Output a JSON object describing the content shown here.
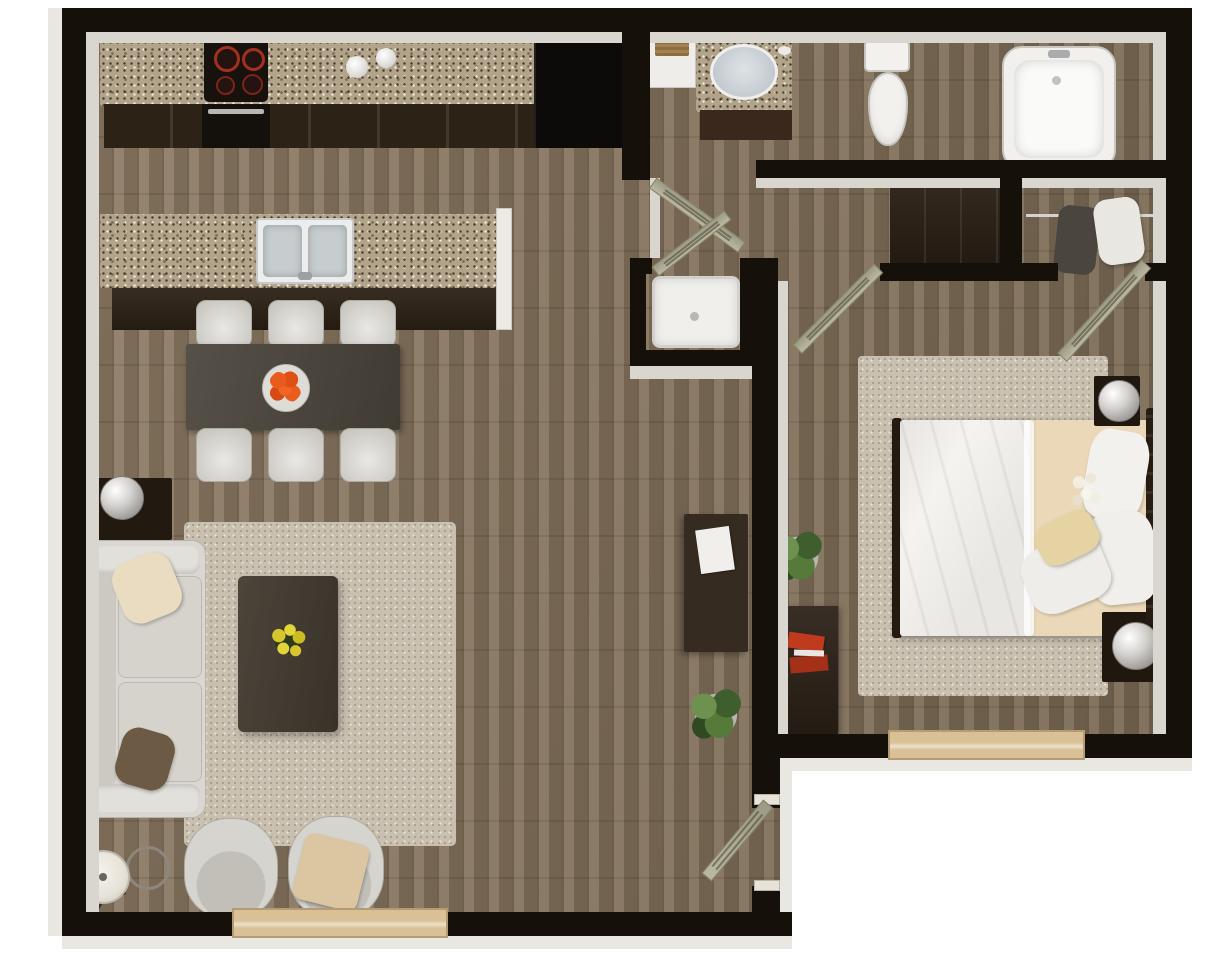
{
  "scene": {
    "type": "floor-plan",
    "render_style": "3d-top-down",
    "description": "One-bedroom apartment 3D floor plan render",
    "rooms": [
      {
        "name": "Kitchen"
      },
      {
        "name": "Dining Area"
      },
      {
        "name": "Living Room"
      },
      {
        "name": "Hallway"
      },
      {
        "name": "Bathroom"
      },
      {
        "name": "Shower Room"
      },
      {
        "name": "Walk-in Closet"
      },
      {
        "name": "Bedroom"
      },
      {
        "name": "Entry"
      }
    ]
  },
  "palette": {
    "wall": "#151009",
    "wall_face": "#d9d6cf",
    "floor_wood": "#86745d",
    "granite": "#b2a48a",
    "cabinet_dark": "#2d2216",
    "door_sage": "#b2b098",
    "rug_beige": "#c9c0b0",
    "fixture_white": "#f2f1ee",
    "sofa_gray": "#d9d7d2",
    "accent_orange": "#e8581f",
    "accent_yellow": "#d8c62e",
    "accent_red": "#c03a1e",
    "pillow_cream": "#e9dcc0",
    "plant_green": "#4c6b38",
    "window_wood": "#d9c096"
  },
  "furniture": {
    "counter": {
      "label": "Kitchen counter with granite top"
    },
    "cooktop": {
      "label": "4-burner cooktop"
    },
    "oven": {
      "label": "Wall oven"
    },
    "canisters": {
      "label": "Counter canisters"
    },
    "refrigerator": {
      "label": "Refrigerator"
    },
    "island": {
      "label": "Kitchen island"
    },
    "island_sink": {
      "label": "Double basin island sink"
    },
    "dining_table": {
      "label": "Dining table"
    },
    "dining_chair": {
      "label": "Dining chair"
    },
    "fruit_plate": {
      "label": "Plate of oranges"
    },
    "sofa": {
      "label": "Three-seat sofa"
    },
    "sofa_pillow_cream": {
      "label": "Cream throw pillow"
    },
    "sofa_pillow_brown": {
      "label": "Brown throw pillow"
    },
    "side_table": {
      "label": "Side table"
    },
    "side_lamp": {
      "label": "Table lamp"
    },
    "living_rug": {
      "label": "Living room area rug"
    },
    "coffee_table": {
      "label": "Coffee table"
    },
    "flowers": {
      "label": "Yellow flower arrangement"
    },
    "accent_chair_a": {
      "label": "Accent swivel chair"
    },
    "accent_chair_b": {
      "label": "Accent swivel chair with throw"
    },
    "throw_blanket": {
      "label": "Beige throw blanket"
    },
    "floor_lamp": {
      "label": "Tripod floor lamp"
    },
    "decor_ring": {
      "label": "Wire sphere decor"
    },
    "desk": {
      "label": "Writing desk"
    },
    "desk_paper": {
      "label": "Papers on desk"
    },
    "plant_living": {
      "label": "Potted plant (living side)"
    },
    "plant_bedroom": {
      "label": "Potted plant (bedroom side)"
    },
    "entry_door": {
      "label": "Entry door"
    },
    "bath_door": {
      "label": "Bathroom door"
    },
    "shower_door": {
      "label": "Shower room door"
    },
    "bedroom_door": {
      "label": "Bedroom door"
    },
    "closet_door": {
      "label": "Closet door"
    },
    "shower_tray": {
      "label": "Walk-in shower"
    },
    "towel_niche": {
      "label": "Towel niche"
    },
    "towel": {
      "label": "Hanging towel"
    },
    "vanity": {
      "label": "Granite vanity"
    },
    "vanity_sink": {
      "label": "Round vanity sink"
    },
    "toilet": {
      "label": "Toilet"
    },
    "bathtub": {
      "label": "Bathtub"
    },
    "hall_dresser": {
      "label": "Hall dresser"
    },
    "closet_rod": {
      "label": "Closet hanging rod"
    },
    "clothes_dark": {
      "label": "Hanging clothes (dark)"
    },
    "clothes_light": {
      "label": "Hanging clothes (light)"
    },
    "bedroom_dresser": {
      "label": "Bedroom dresser"
    },
    "books": {
      "label": "Red books"
    },
    "bed": {
      "label": "Queen bed"
    },
    "duvet": {
      "label": "White duvet"
    },
    "sheet": {
      "label": "Beige fitted sheet"
    },
    "pillow": {
      "label": "Bed pillow"
    },
    "headboard": {
      "label": "Dark wood headboard"
    },
    "nightstand_a": {
      "label": "Nightstand"
    },
    "nightstand_b": {
      "label": "Nightstand"
    },
    "lamp_a": {
      "label": "Bedside lamp"
    },
    "lamp_b": {
      "label": "Bedside lamp"
    },
    "bedroom_rug": {
      "label": "Bedroom area rug"
    },
    "window_living": {
      "label": "Living room window"
    },
    "window_bedroom": {
      "label": "Bedroom window"
    }
  }
}
